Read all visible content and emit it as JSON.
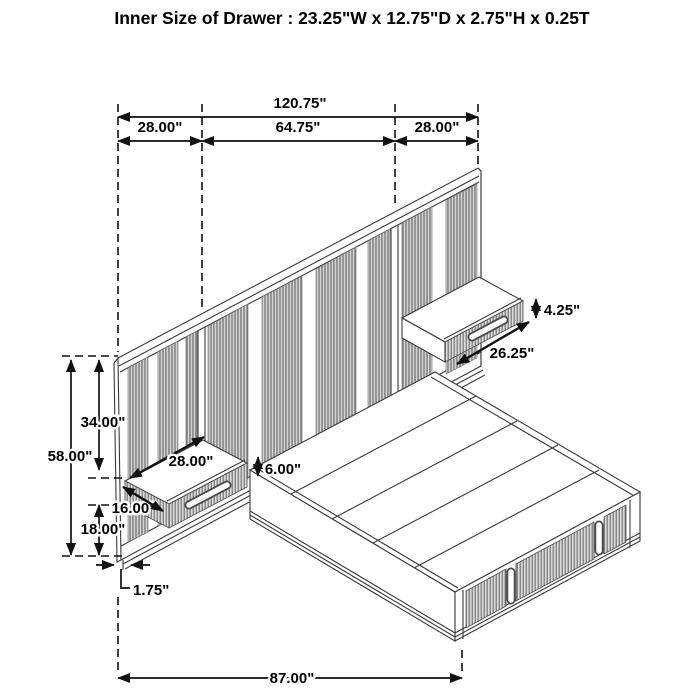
{
  "title": "Inner Size of Drawer : 23.25\"W x 12.75\"D x 2.75\"H x 0.25T",
  "drawer_inner_size": {
    "width": "23.25\"",
    "depth": "12.75\"",
    "height": "2.75\"",
    "thickness": "0.25T"
  },
  "line_color": "#111111",
  "dimensions": {
    "overall_width": "120.75\"",
    "left_section_width": "28.00\"",
    "center_section_width": "64.75\"",
    "right_section_width": "28.00\"",
    "right_nightstand_height": "4.25\"",
    "right_nightstand_width": "26.25\"",
    "panel_above_nightstand": "34.00\"",
    "headboard_height": "58.00\"",
    "left_nightstand_width": "28.00\"",
    "left_nightstand_height": "6.00\"",
    "left_nightstand_depth": "16.00\"",
    "nightstand_floor_clearance": "18.00\"",
    "base_inset": "1.75\"",
    "bed_length": "87.00\""
  }
}
